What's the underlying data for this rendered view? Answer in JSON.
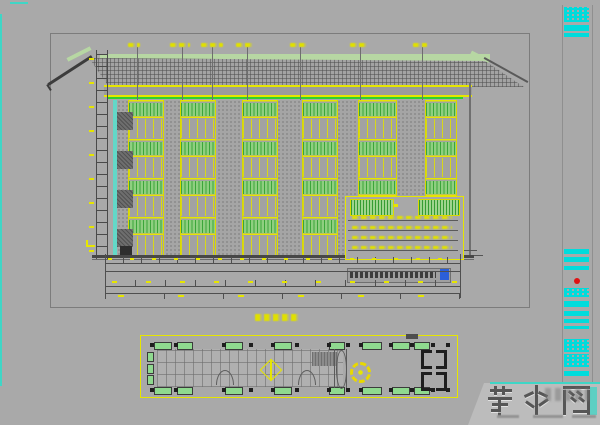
{
  "page": {
    "background": "#a9a9a9",
    "kind": "cad-drawing-viewport"
  },
  "colors": {
    "background": "#a9a9a9",
    "line_yellow": "#e6e600",
    "line_green": "#2fd12f",
    "band_green": "#b7d7a3",
    "window_hatch_green": "#8fcf80",
    "teal_wall": "#63d8c8",
    "titleblock_cyan": "#00dcdc",
    "red_seal": "#e01212",
    "dim_line": "#4f4f4f",
    "sheet_frame": "#7c7c7c",
    "note_highlight_blue": "#2b5fd9",
    "watermark_bg": "#bcbcbc",
    "watermark_text": "#565656",
    "watermark_accent": "#3fd6c6"
  },
  "elevation": {
    "bay_count": 6,
    "floor_count": 4,
    "axis_marker_count": 7,
    "has_left_dimension_ladder": true,
    "has_detail_inset": true
  },
  "note_box": {
    "has_blue_selection_cursor": true
  },
  "dimensions": {
    "string_rows": 4
  },
  "plan": {
    "window_block_count_top": 8,
    "window_block_count_bottom": 8,
    "column_dot_count": 13,
    "has_center_diamond": true,
    "has_gear_symbol": true,
    "bracket_pair_count": 2
  },
  "titleblock": {
    "block_count": 14,
    "has_red_seal": true
  },
  "watermark": {
    "text": "若水网",
    "chars": [
      "若",
      "水",
      "网"
    ]
  }
}
